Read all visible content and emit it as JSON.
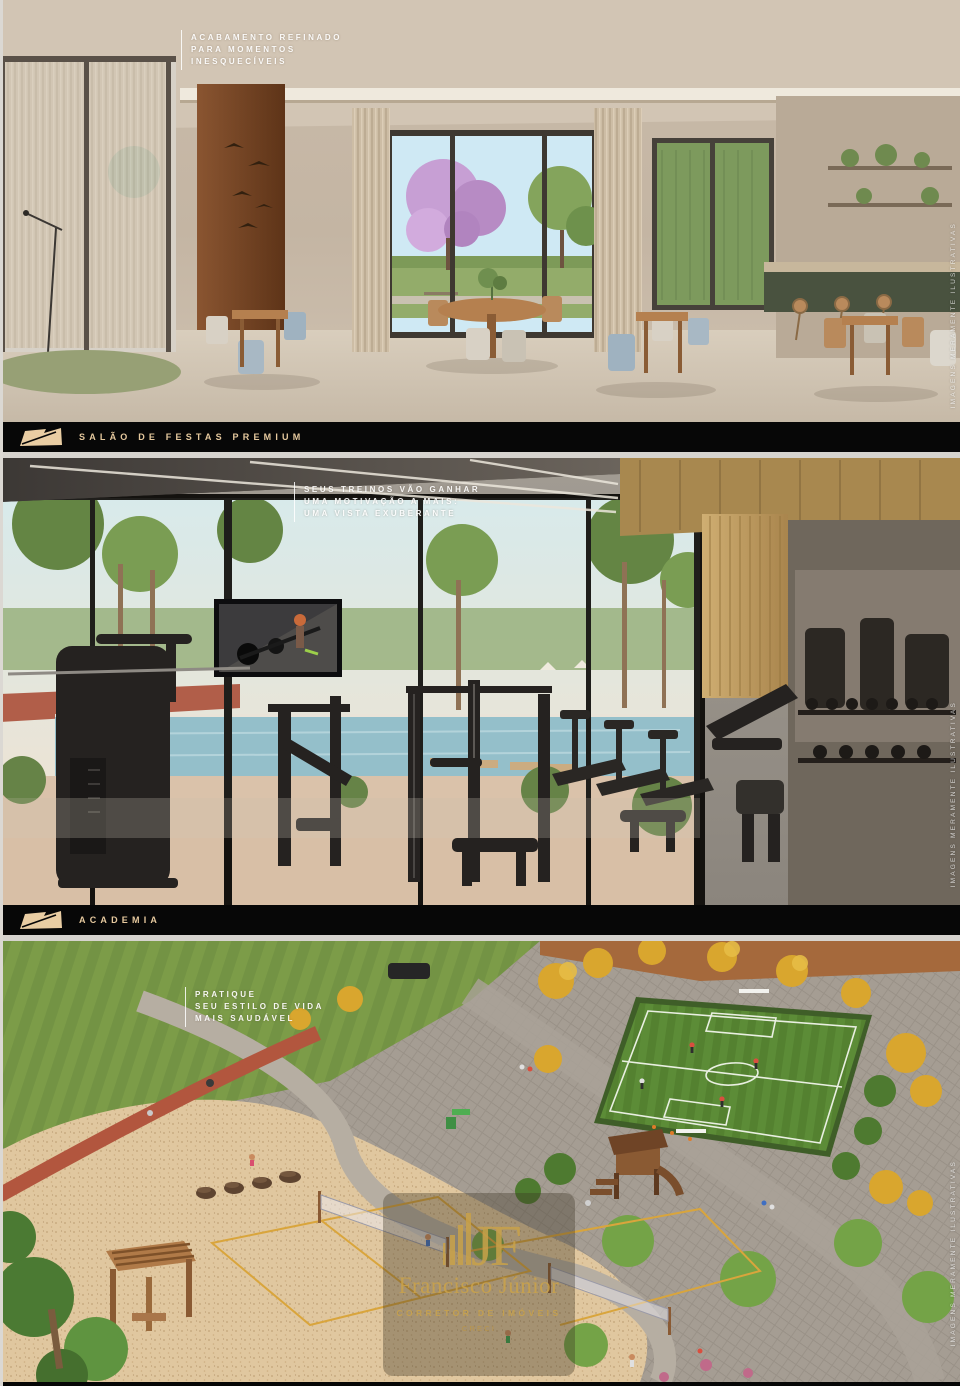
{
  "panels": [
    {
      "id": "salao-de-festas",
      "caption_lines": [
        "ACABAMENTO REFINADO",
        "PARA MOMENTOS",
        "INESQUECÍVEIS"
      ],
      "label": "SALÃO DE FESTAS PREMIUM"
    },
    {
      "id": "academia",
      "caption_lines": [
        "SEUS TREINOS VÃO GANHAR",
        "UMA MOTIVAÇÃO A MAIS:",
        "UMA VISTA EXUBERANTE"
      ],
      "label": "ACADEMIA"
    },
    {
      "id": "area-externa",
      "caption_lines": [
        "PRATIQUE",
        "SEU ESTILO DE VIDA",
        "MAIS SAUDÁVEL"
      ]
    }
  ],
  "disclaimer": "IMAGENS MERAMENTE ILUSTRATIVAS",
  "watermark": {
    "monogram": "JF",
    "name": "Francisco Júnior",
    "role": "CORRETOR DE IMÓVEIS",
    "creci": "CRECI"
  },
  "colors": {
    "bar_background": "#070707",
    "bar_text": "#e6c99e",
    "logo_mark": "#e9cda3",
    "watermark_gold": "#c9a24a"
  }
}
